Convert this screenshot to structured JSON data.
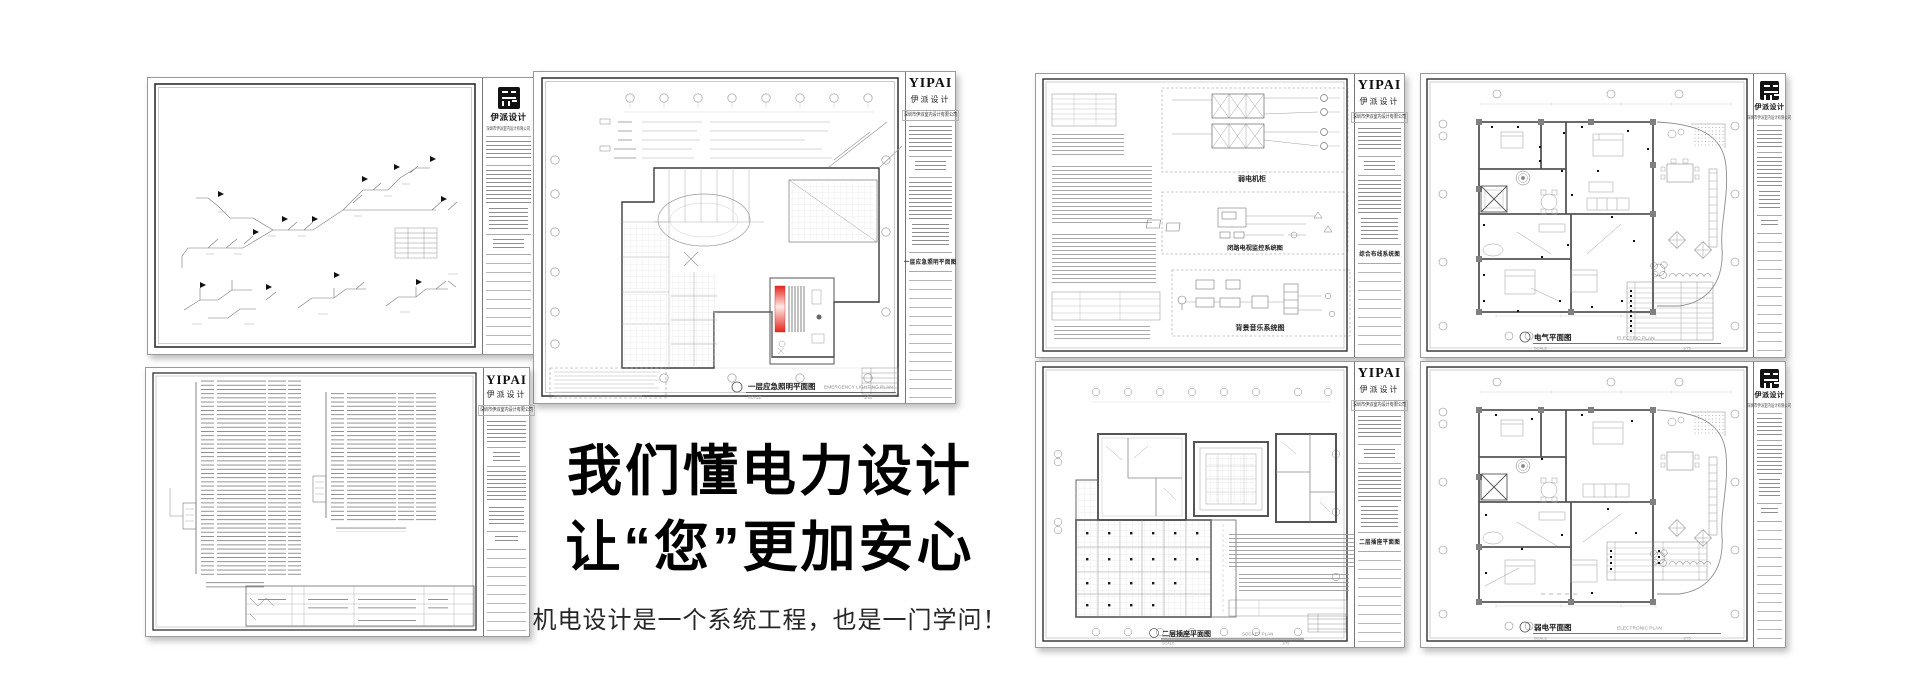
{
  "hero": {
    "heading_line1": "我们懂电力设计",
    "heading_line2": "让“您”更加安心",
    "subtitle": "机电设计是一个系统工程，也是一门学问！"
  },
  "brand": {
    "wordmark": "YIPAI",
    "wordmark_cn": "伊派设计",
    "company": "深圳市伊派室内设计有限公司",
    "seal_icon": "yipai-seal-logo"
  },
  "colors": {
    "accent_red": "#e4261c",
    "drawing_line": "#8d8d8d",
    "ink": "#111111"
  },
  "sheets": {
    "emergency_lighting": {
      "title_cn": "一层应急照明平面图",
      "title_en": "EMERGENCY LIGHTING PLAN",
      "scale_label": "SCALE",
      "scale": "1/50"
    },
    "systems": {
      "cabinet_label": "弱电机柜",
      "cctv_label": "闭路电视监控系统图",
      "bgm_label": "背景音乐系统图",
      "block_title": "综合布线系统图"
    },
    "electric": {
      "title_cn": "电气平面图",
      "title_en": "ELECTRIC PLAN",
      "scale_label": "SCALE",
      "scale": "1/75"
    },
    "socket": {
      "title_cn": "二层插座平面图",
      "title_en": "SOCKET PLAN",
      "scale_label": "SCALE",
      "scale": "1/75"
    },
    "elv": {
      "title_cn": "弱电平面图",
      "title_en": "ELECTRONIC PLAN",
      "scale_label": "SCALE",
      "scale": "1/75"
    }
  }
}
